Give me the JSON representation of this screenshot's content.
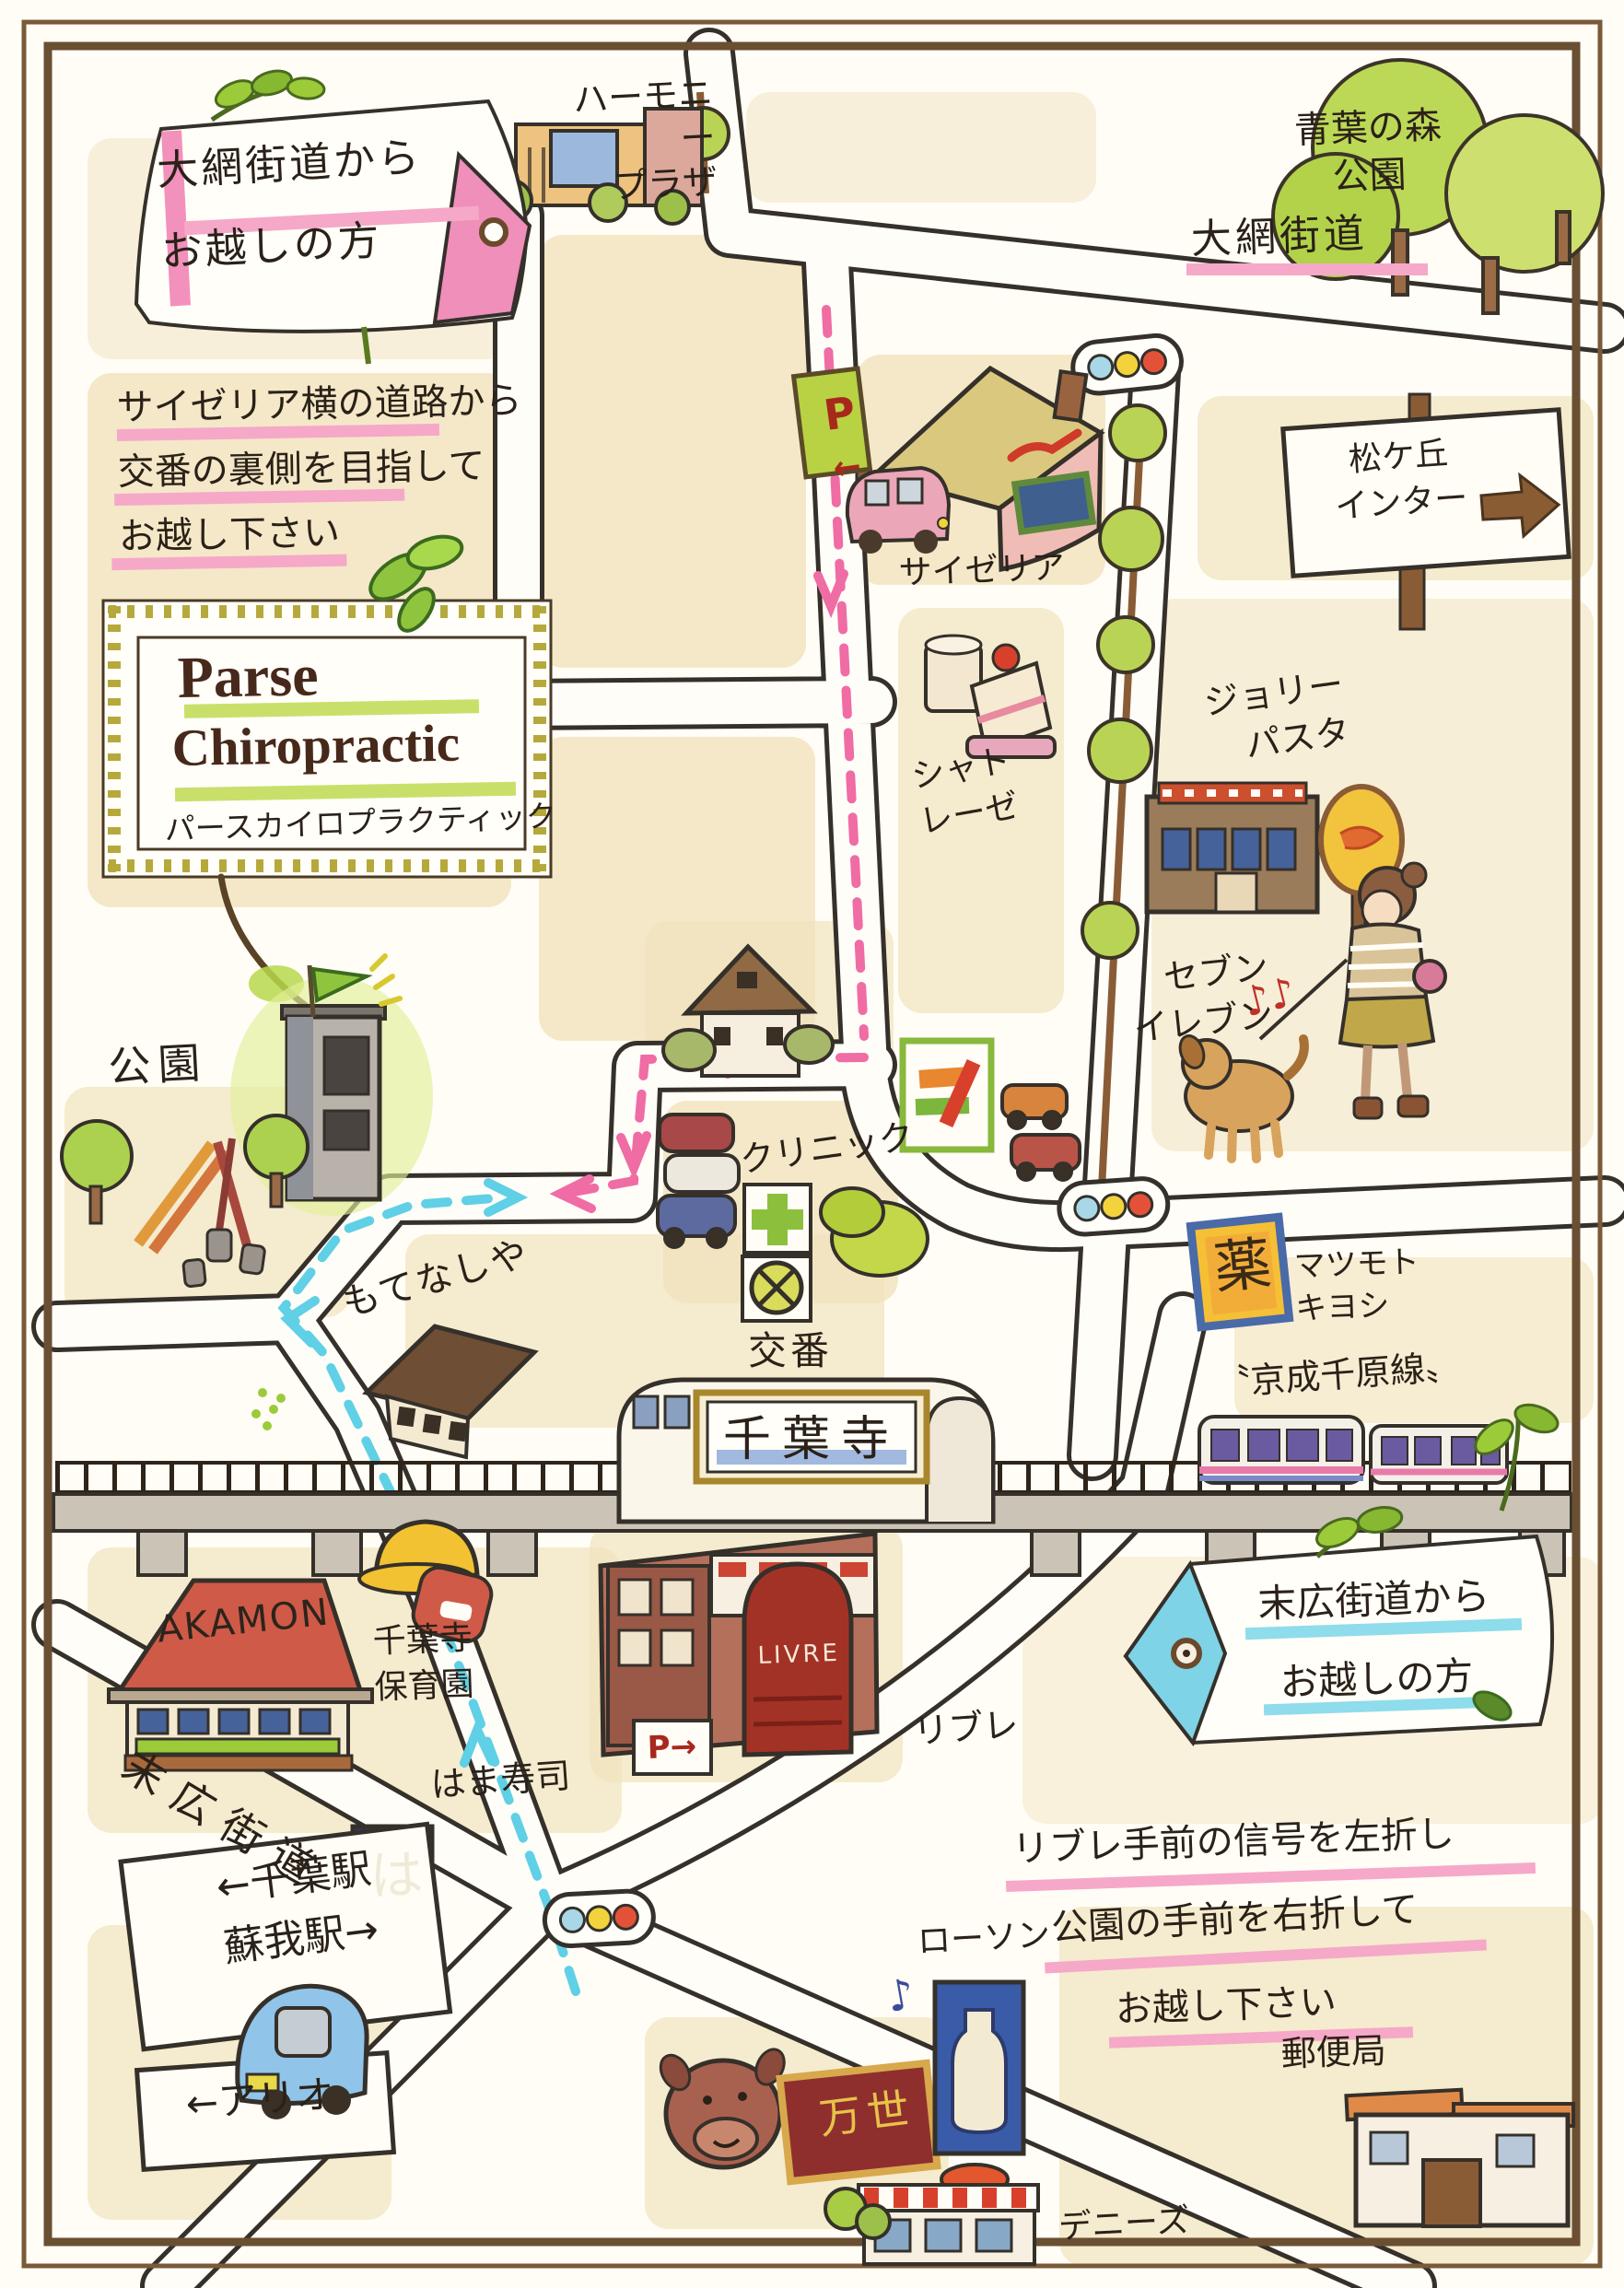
{
  "title": "Parse Chiropractic 案内マップ",
  "logo": {
    "en1": "Parse",
    "en2": "Chiropractic",
    "ja": "パースカイロプラクティック"
  },
  "tags": {
    "oami": "大網街道から\nお越しの方",
    "suehiro": "末広街道から\nお越しの方"
  },
  "notes": {
    "oami": "サイゼリア横の道路から\n交番の裏側を目指して\nお越し下さい",
    "suehiro_line1": "リブレ手前の信号を左折し",
    "suehiro_line2": "公園の手前を右折して",
    "suehiro_line3": "お越し下さい"
  },
  "roads": {
    "oami": "大網街道",
    "suehiro": "末広街道",
    "rail": "〝京成千原線〟"
  },
  "signs": {
    "matsugaoka": "松ケ丘\nインター",
    "chiba_soga": "←千葉駅\n蘇我駅→",
    "ario": "←アリオ",
    "p": "P",
    "p_arrow": "←",
    "livre_p": "P→",
    "yaku": "薬",
    "ha": "は",
    "station": "千葉寺",
    "livre_logo": "LIVRE"
  },
  "places": {
    "harmony": "ハーモニー\nプラザ",
    "aoba": "青葉の森\n公園",
    "saizeriya": "サイゼリア",
    "chateraise": "シャト\nレーゼ",
    "jolly": "ジョリー\nパスタ",
    "seven": "セブン\nイレブン",
    "clinic": "クリニック",
    "koban": "交番",
    "park": "公園",
    "motenashiya": "もてなしや",
    "matsukiyo": "マツモト\nキヨシ",
    "livre": "リブレ",
    "akamon": "AKAMON",
    "hoikuen": "千葉寺\n保育園",
    "hamazushi": "はま寿司",
    "lawson": "ローソン",
    "manse": "万世",
    "dennys": "デニーズ",
    "post": "郵便局"
  },
  "decor": {
    "notes_red": "♪♪",
    "note_blue": "♪"
  },
  "colors": {
    "route_pink": "#f06ca4",
    "route_blue": "#5fd0e6",
    "block_tan": "#f1e2bd",
    "frame_brown": "#6b4f32",
    "highlight_green": "#c8e06a",
    "underline_pink": "#f6a8c8",
    "underline_cyan": "#8edcec"
  }
}
